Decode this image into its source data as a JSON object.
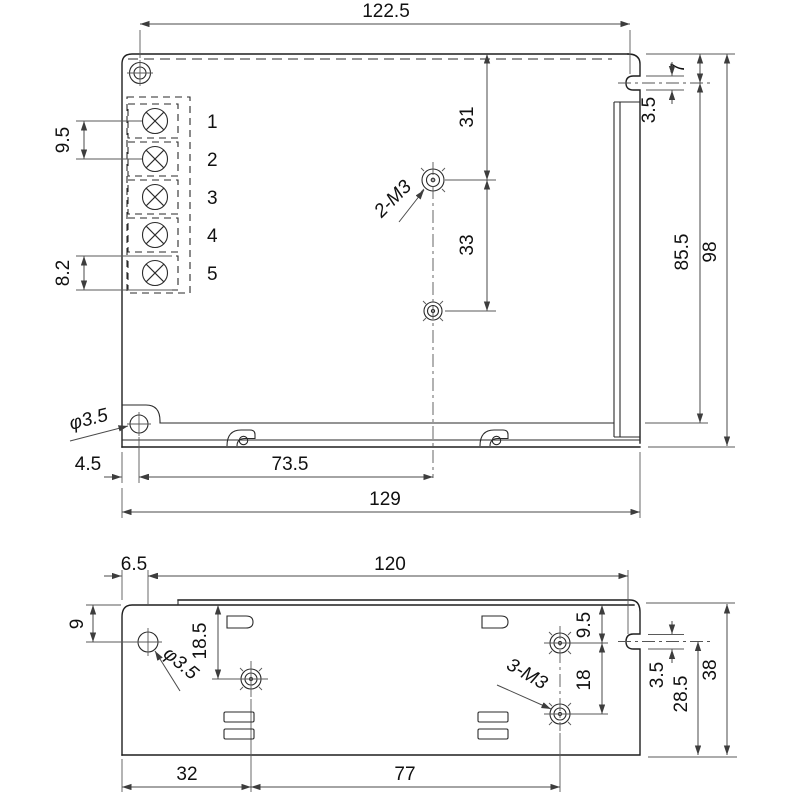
{
  "colors": {
    "line": "#1f1f1f",
    "dimension": "#4a4a4a",
    "background": "#ffffff"
  },
  "top_view": {
    "width_top": "122.5",
    "terminal_pitch": "9.5",
    "terminal_height": "8.2",
    "terminal_labels": [
      "1",
      "2",
      "3",
      "4",
      "5"
    ],
    "stud_label": "2-M3",
    "stud_from_top": "31",
    "stud_spacing": "33",
    "slot_from_top": "7",
    "slot_width": "3.5",
    "slot_to_bottom": "85.5",
    "height": "98",
    "hole_label": "φ3.5",
    "hole_from_left": "4.5",
    "hole_to_stud": "73.5",
    "width": "129"
  },
  "bottom_view": {
    "hole_from_left": "6.5",
    "width_top": "120",
    "hole_from_top": "9",
    "hole_label": "φ3.5",
    "stud_left_from_top": "18.5",
    "stud_right_from_top": "9.5",
    "stud_right_spacing": "18",
    "slot_width": "3.5",
    "slot_to_bottom": "28.5",
    "height": "38",
    "stud_label": "3-M3",
    "stud_left_from_edge": "32",
    "stud_spacing_x": "77"
  }
}
